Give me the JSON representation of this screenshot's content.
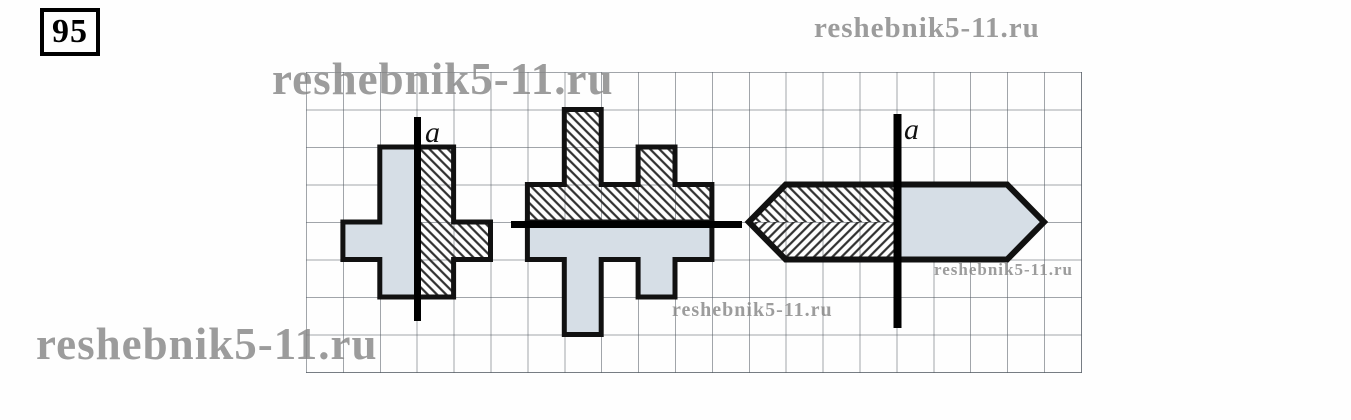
{
  "problem_number": "95",
  "watermarks": {
    "top_right": "reshebnik5-11.ru",
    "upper_left": "reshebnik5-11.ru",
    "bottom_left": "reshebnik5-11.ru",
    "middle": "reshebnik5-11.ru",
    "right": "reshebnik5-11.ru"
  },
  "axis_labels": {
    "figure1": "a",
    "figure3": "a"
  },
  "figures": {
    "figure1": "cross-shape-with-vertical-symmetry-axis",
    "figure2": "stepped-shape-with-horizontal-symmetry-axis",
    "figure3": "arrow-hexagon-with-vertical-symmetry-axis"
  },
  "colors": {
    "solid_half_fill": "#d6dee6",
    "hatch_stroke": "#2e2e2e",
    "shape_outline": "#111111",
    "axis_line": "#000000",
    "grid_line": "#82878d",
    "watermark_gray": "#878787"
  }
}
